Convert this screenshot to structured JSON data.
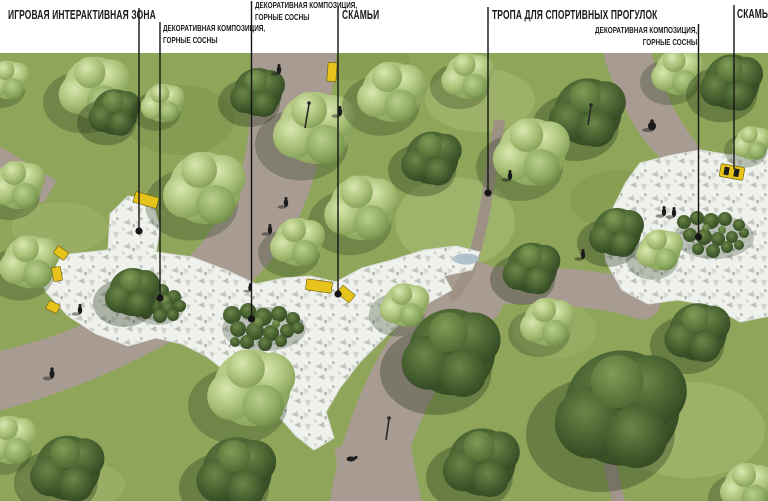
{
  "annotations": [
    {
      "id": "play-zone",
      "line1": "ИГРОВАЯ ИНТЕРАКТИВНАЯ ЗОНА",
      "line2": ""
    },
    {
      "id": "decorative-pines-left",
      "line1": "ДЕКОРАТИВНАЯ КОМПОЗИЦИЯ,",
      "line2": "ГОРНЫЕ СОСНЫ"
    },
    {
      "id": "decorative-pines-center",
      "line1": "ДЕКОРАТИВНАЯ КОМПОЗИЦИЯ,",
      "line2": "ГОРНЫЕ СОСНЫ"
    },
    {
      "id": "benches-center",
      "line1": "СКАМЬИ",
      "line2": ""
    },
    {
      "id": "sport-trail",
      "line1": "ТРОПА ДЛЯ СПОРТИВНЫХ ПРОГУЛОК",
      "line2": ""
    },
    {
      "id": "decorative-pines-right",
      "line1": "ДЕКОРАТИВНАЯ КОМПОЗИЦИЯ,",
      "line2": "ГОРНЫЕ СОСНЫ"
    },
    {
      "id": "bench-right",
      "line1": "СКАМЬЯ",
      "line2": ""
    }
  ],
  "colors": {
    "label_text": "#1b1b1b",
    "leader_line": "#151515",
    "band_background": "#ffffff",
    "grass": "#8ea55a",
    "path_gravel": "#a89b92",
    "pavers_white": "#eff1ec",
    "pine_dark_green": "#46602f",
    "bench_yellow": "#e7c41c",
    "water": "#a8bdc9"
  }
}
